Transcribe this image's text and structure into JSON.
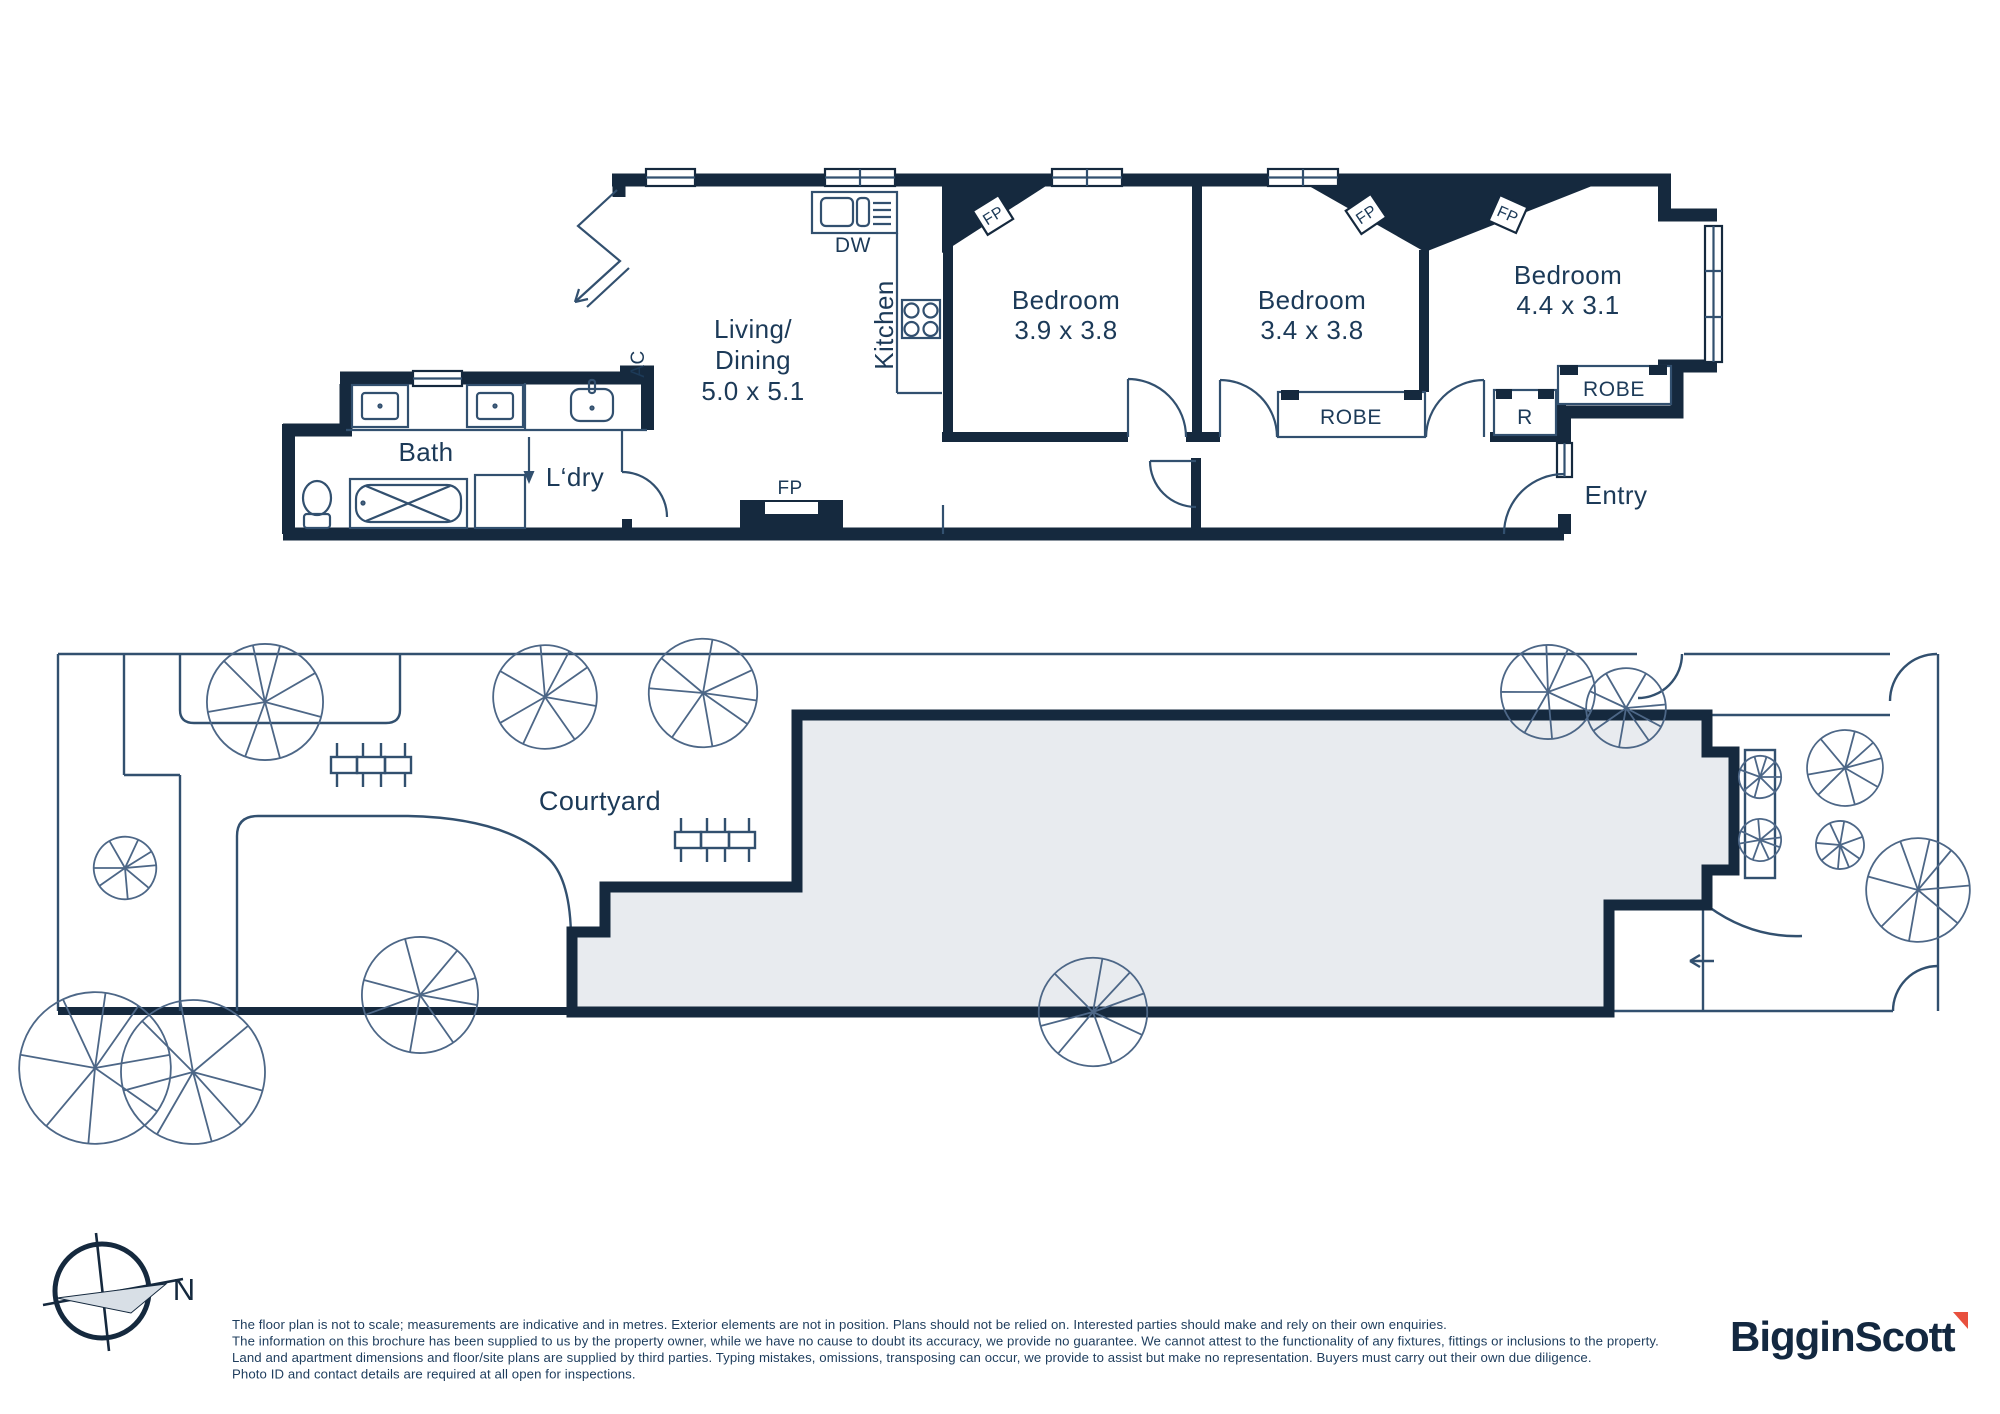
{
  "colors": {
    "navy": "#15293E",
    "line": "#32506F",
    "tree_line": "#4D6787",
    "footprint_fill": "#E8EBEF",
    "compass_gray": "#D8DFE6",
    "text": "#1C3A58",
    "logo_navy": "#132840",
    "logo_red": "#E8503E",
    "disclaimer_text": "#1D3C5C"
  },
  "floorplan": {
    "rooms": {
      "living": {
        "name_line1": "Living/",
        "name_line2": "Dining",
        "dims": "5.0 x 5.1"
      },
      "kitchen": {
        "name": "Kitchen"
      },
      "bedroom1": {
        "name": "Bedroom",
        "dims": "3.9 x 3.8"
      },
      "bedroom2": {
        "name": "Bedroom",
        "dims": "3.4 x 3.8"
      },
      "bedroom3": {
        "name": "Bedroom",
        "dims": "4.4 x 3.1"
      },
      "bath": {
        "name": "Bath"
      },
      "laundry": {
        "name": "L‘dry"
      },
      "entry": {
        "name": "Entry"
      }
    },
    "fixtures": {
      "dishwasher": "DW",
      "robe": "ROBE",
      "robe_small": "R",
      "fireplace": "FP",
      "air_conditioner": "AC"
    }
  },
  "site": {
    "courtyard_label": "Courtyard"
  },
  "compass": {
    "north_label": "N"
  },
  "disclaimer": {
    "lines": [
      "The floor plan is not to scale; measurements are indicative and in metres. Exterior elements are not in position. Plans should not be relied on. Interested parties should make and rely on their own enquiries.",
      "The information on this brochure has been supplied to us by the property owner, while we have no cause to doubt its accuracy, we provide no guarantee. We cannot attest to the functionality of any fixtures, fittings or inclusions to the property.",
      "Land and apartment dimensions and floor/site plans are supplied by third parties. Typing mistakes, omissions, transposing can occur, we provide to assist but make no representation. Buyers must carry out their own due diligence.",
      "Photo ID and contact details are required at all open for inspections."
    ]
  },
  "logo": {
    "brand": "BigginScott"
  }
}
